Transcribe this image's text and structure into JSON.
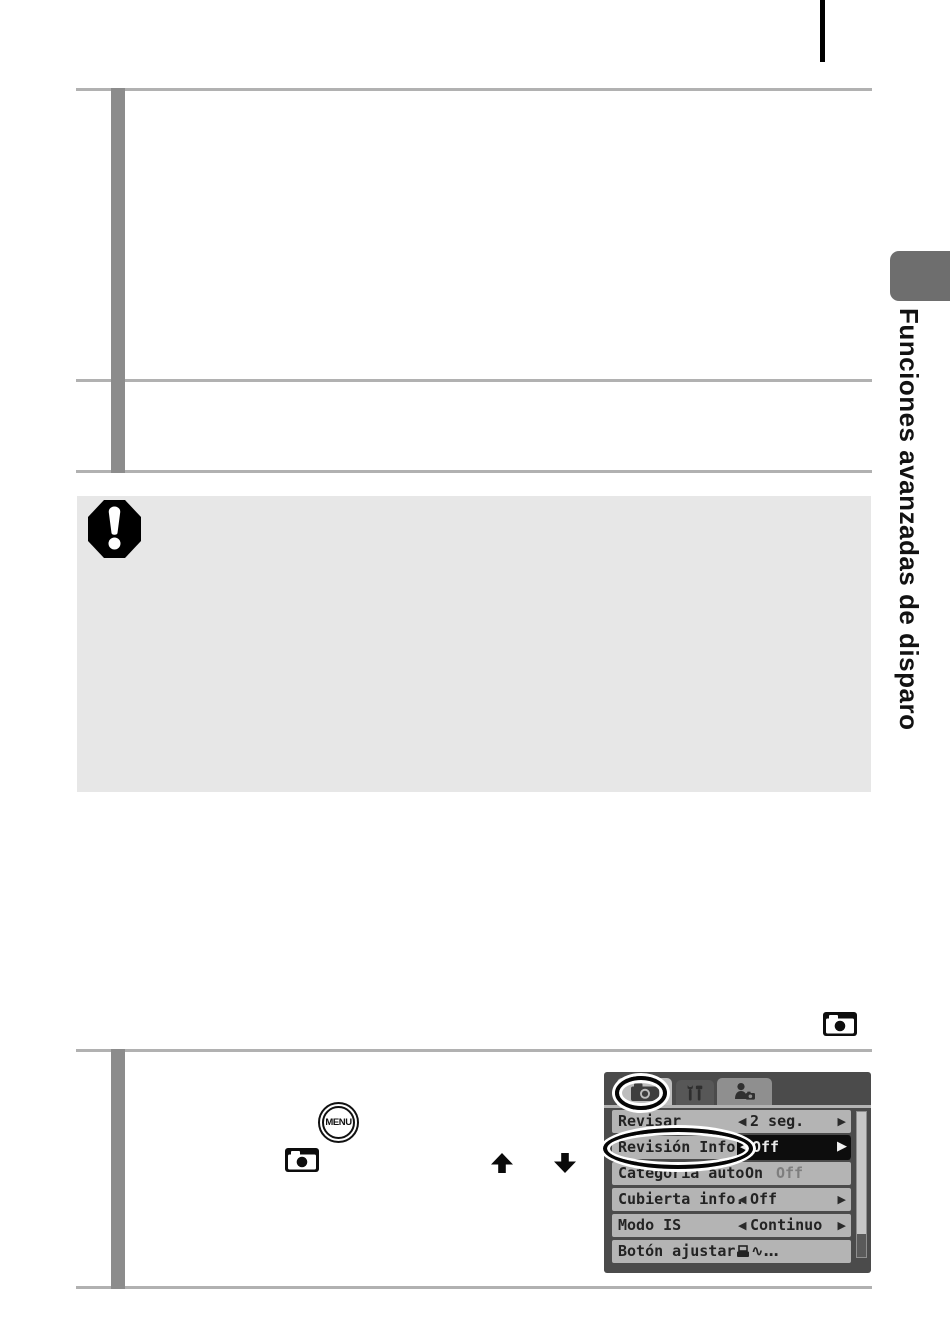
{
  "sidebar": {
    "section_title": "Funciones avanzadas de disparo"
  },
  "step_graphics": {
    "menu_button_label": "MENU"
  },
  "camera_menu": {
    "tabs": [
      {
        "name": "shooting-tab",
        "icon": "camera-icon",
        "active": true
      },
      {
        "name": "setup-tab",
        "icon": "wrench-hammer-icon",
        "active": false
      },
      {
        "name": "my-camera-tab",
        "icon": "person-camera-icon",
        "active": false
      }
    ],
    "rows": [
      {
        "label": "Revisar",
        "value": "2 seg."
      },
      {
        "label": "Revisión Info.",
        "value": "Off",
        "highlighted": true
      },
      {
        "label": "Categoría auto",
        "option_on": "On",
        "option_off": "Off"
      },
      {
        "label": "Cubierta info.",
        "value": "Off"
      },
      {
        "label": "Modo IS",
        "value": "Continuo"
      },
      {
        "label": "Botón ajustar",
        "value_suffix": "∿…"
      }
    ],
    "glyphs": {
      "left_arrow": "◀",
      "right_arrow": "▶"
    }
  },
  "icons": {
    "important-icon": "black octagon with white exclamation mark",
    "shooting-mode-icon": "black tile, white camera silhouette, black lens dot",
    "up-arrow-icon": "solid black up arrow",
    "down-arrow-icon": "solid black down arrow",
    "menu-button-icon": "double-ring circle with MENU text",
    "printer-share-icon": "small printer glyph in Botón ajustar row"
  },
  "colors": {
    "rule_gray": "#b1b1b1",
    "step_bar_gray": "#8c8c8c",
    "note_box_gray": "#e7e7e7",
    "sidebar_tab_gray": "#6e6e6e",
    "lcd_background": "#4b4b4b",
    "lcd_row_gray": "#b4b4b4",
    "lcd_selected_black": "#0d0d0d"
  }
}
